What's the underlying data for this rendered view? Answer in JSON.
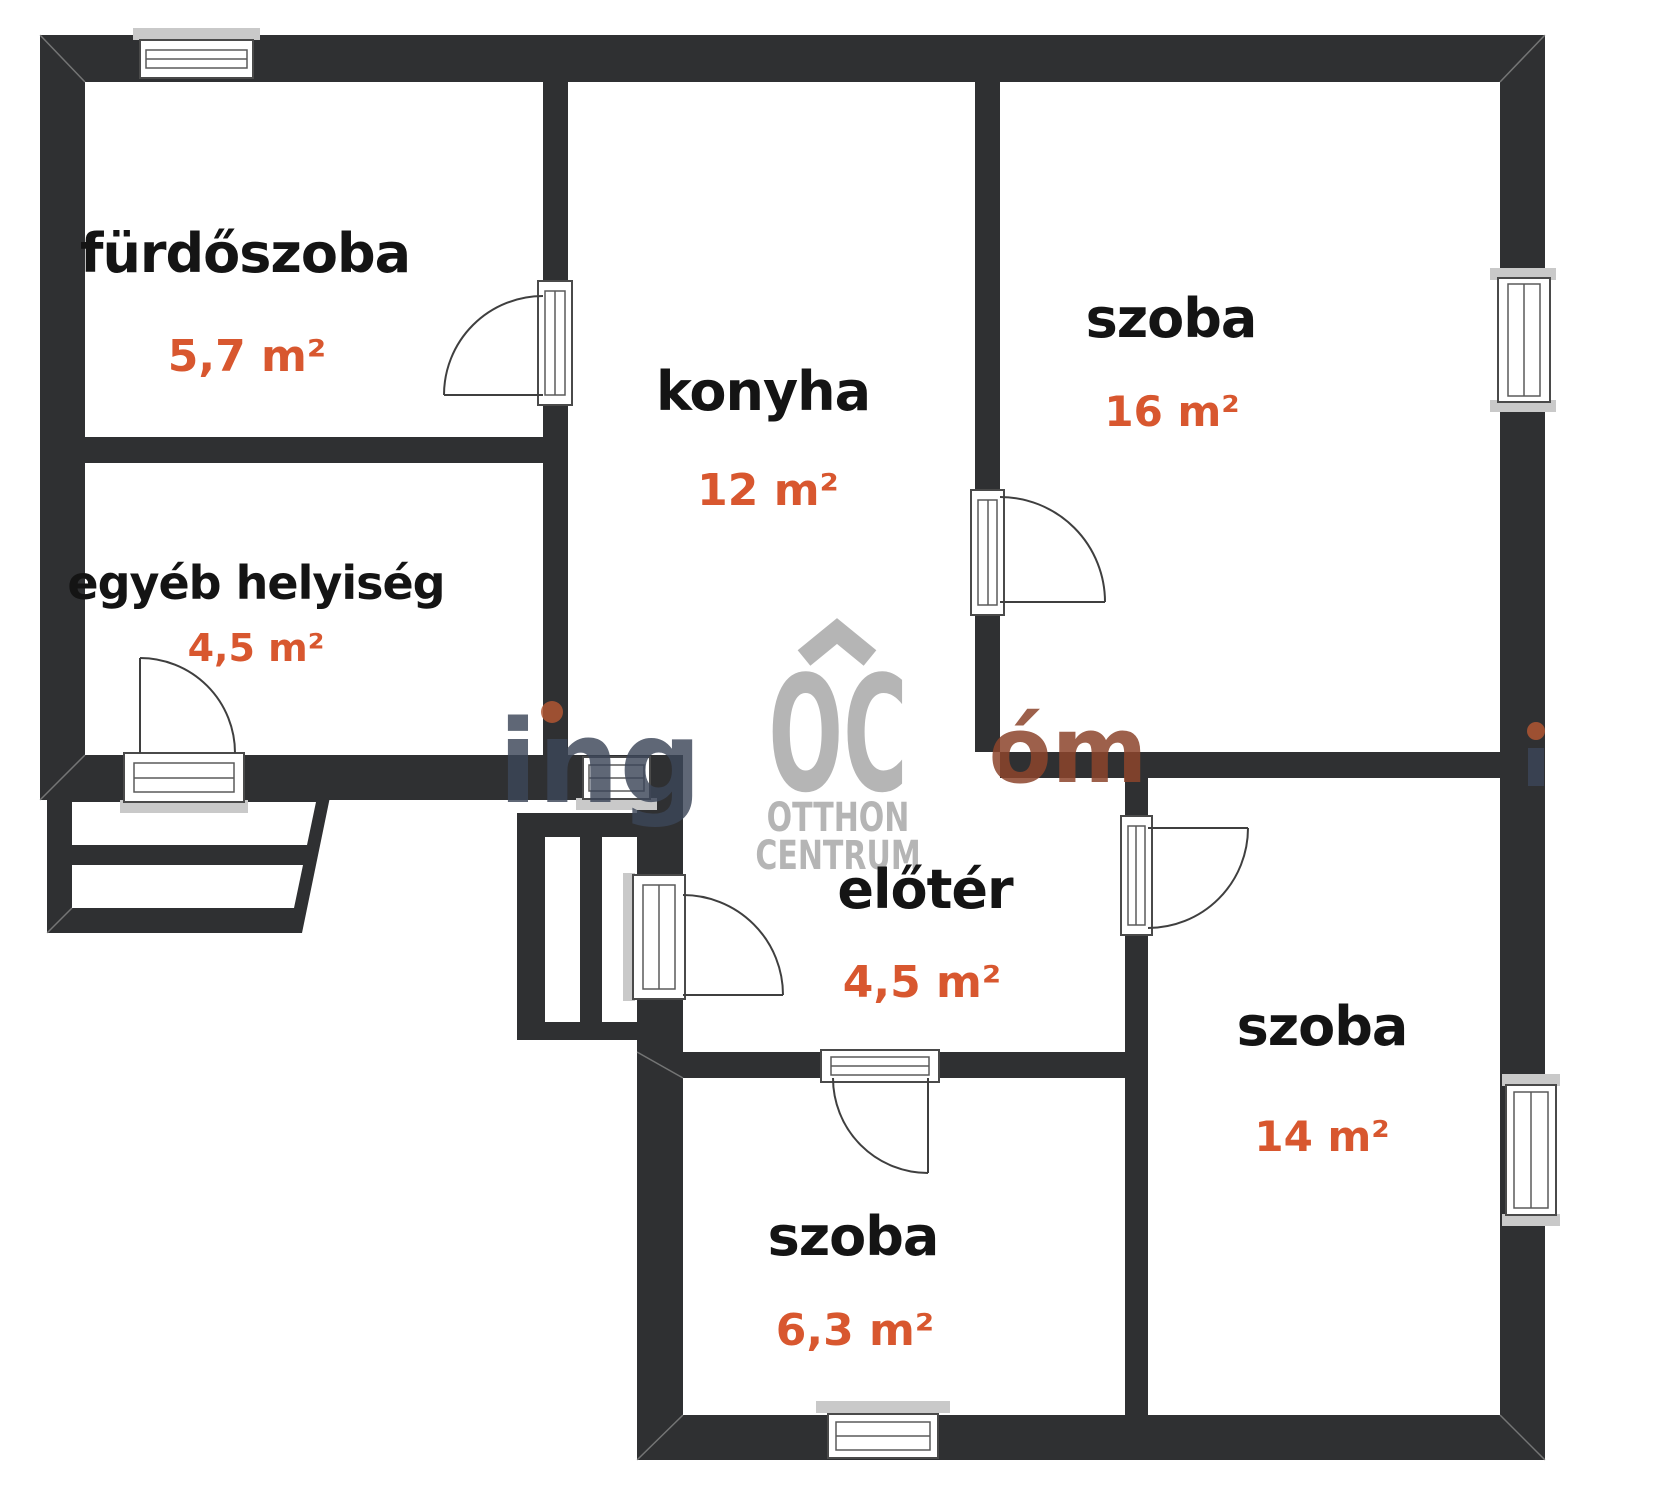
{
  "plan": {
    "type": "floor-plan",
    "rooms": [
      {
        "id": "furdoszoba",
        "name": "fürdőszoba",
        "area": "5,7 m²"
      },
      {
        "id": "egyeb-helyiseg",
        "name": "egyéb helyiség",
        "area": "4,5 m²"
      },
      {
        "id": "konyha",
        "name": "konyha",
        "area": "12 m²"
      },
      {
        "id": "szoba-16",
        "name": "szoba",
        "area": "16 m²"
      },
      {
        "id": "eloter",
        "name": "előtér",
        "area": "4,5 m²"
      },
      {
        "id": "szoba-14",
        "name": "szoba",
        "area": "14 m²"
      },
      {
        "id": "szoba-63",
        "name": "szoba",
        "area": "6,3 m²"
      }
    ]
  },
  "watermark": {
    "logo": {
      "letters": "OC",
      "line1": "OTTHON",
      "line2": "CENTRUM"
    },
    "fragments": {
      "left": "ing",
      "right": "óm"
    }
  },
  "colors": {
    "wall": "#2f3032",
    "room_label": "#141414",
    "area_label": "#d8572f",
    "logo_gray": "#b5b5b5",
    "watermark_left": "#3c4659",
    "watermark_right": "#8c452c",
    "watermark_dot": "#b05633",
    "sill_gray": "#c9c9c9"
  }
}
